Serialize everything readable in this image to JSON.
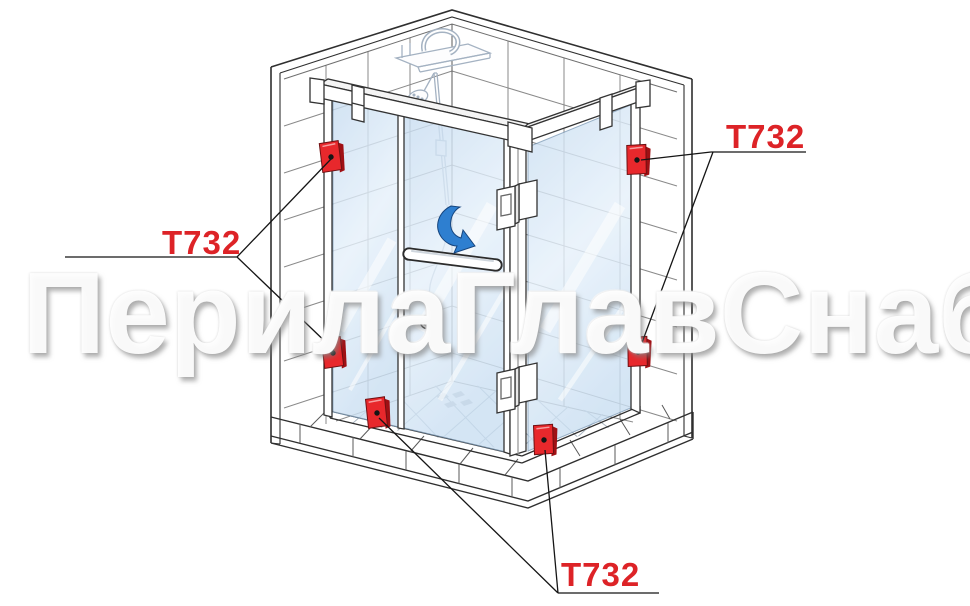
{
  "diagram": {
    "watermark_text": "ПерилаГлавСнаб",
    "part_code": "Т732",
    "callouts": {
      "left": "Т732",
      "top_right": "Т732",
      "bottom": "Т732"
    },
    "markers": {
      "type": "glass-clamp-marker",
      "count": 6,
      "color": "#e8282c"
    },
    "colors": {
      "callout_red": "#dd2327",
      "glass_blue": "#cfe3f5",
      "arrow_blue": "#2e7fd0",
      "outline": "#2f2f2f",
      "tile_line": "#8a8a8a"
    }
  }
}
